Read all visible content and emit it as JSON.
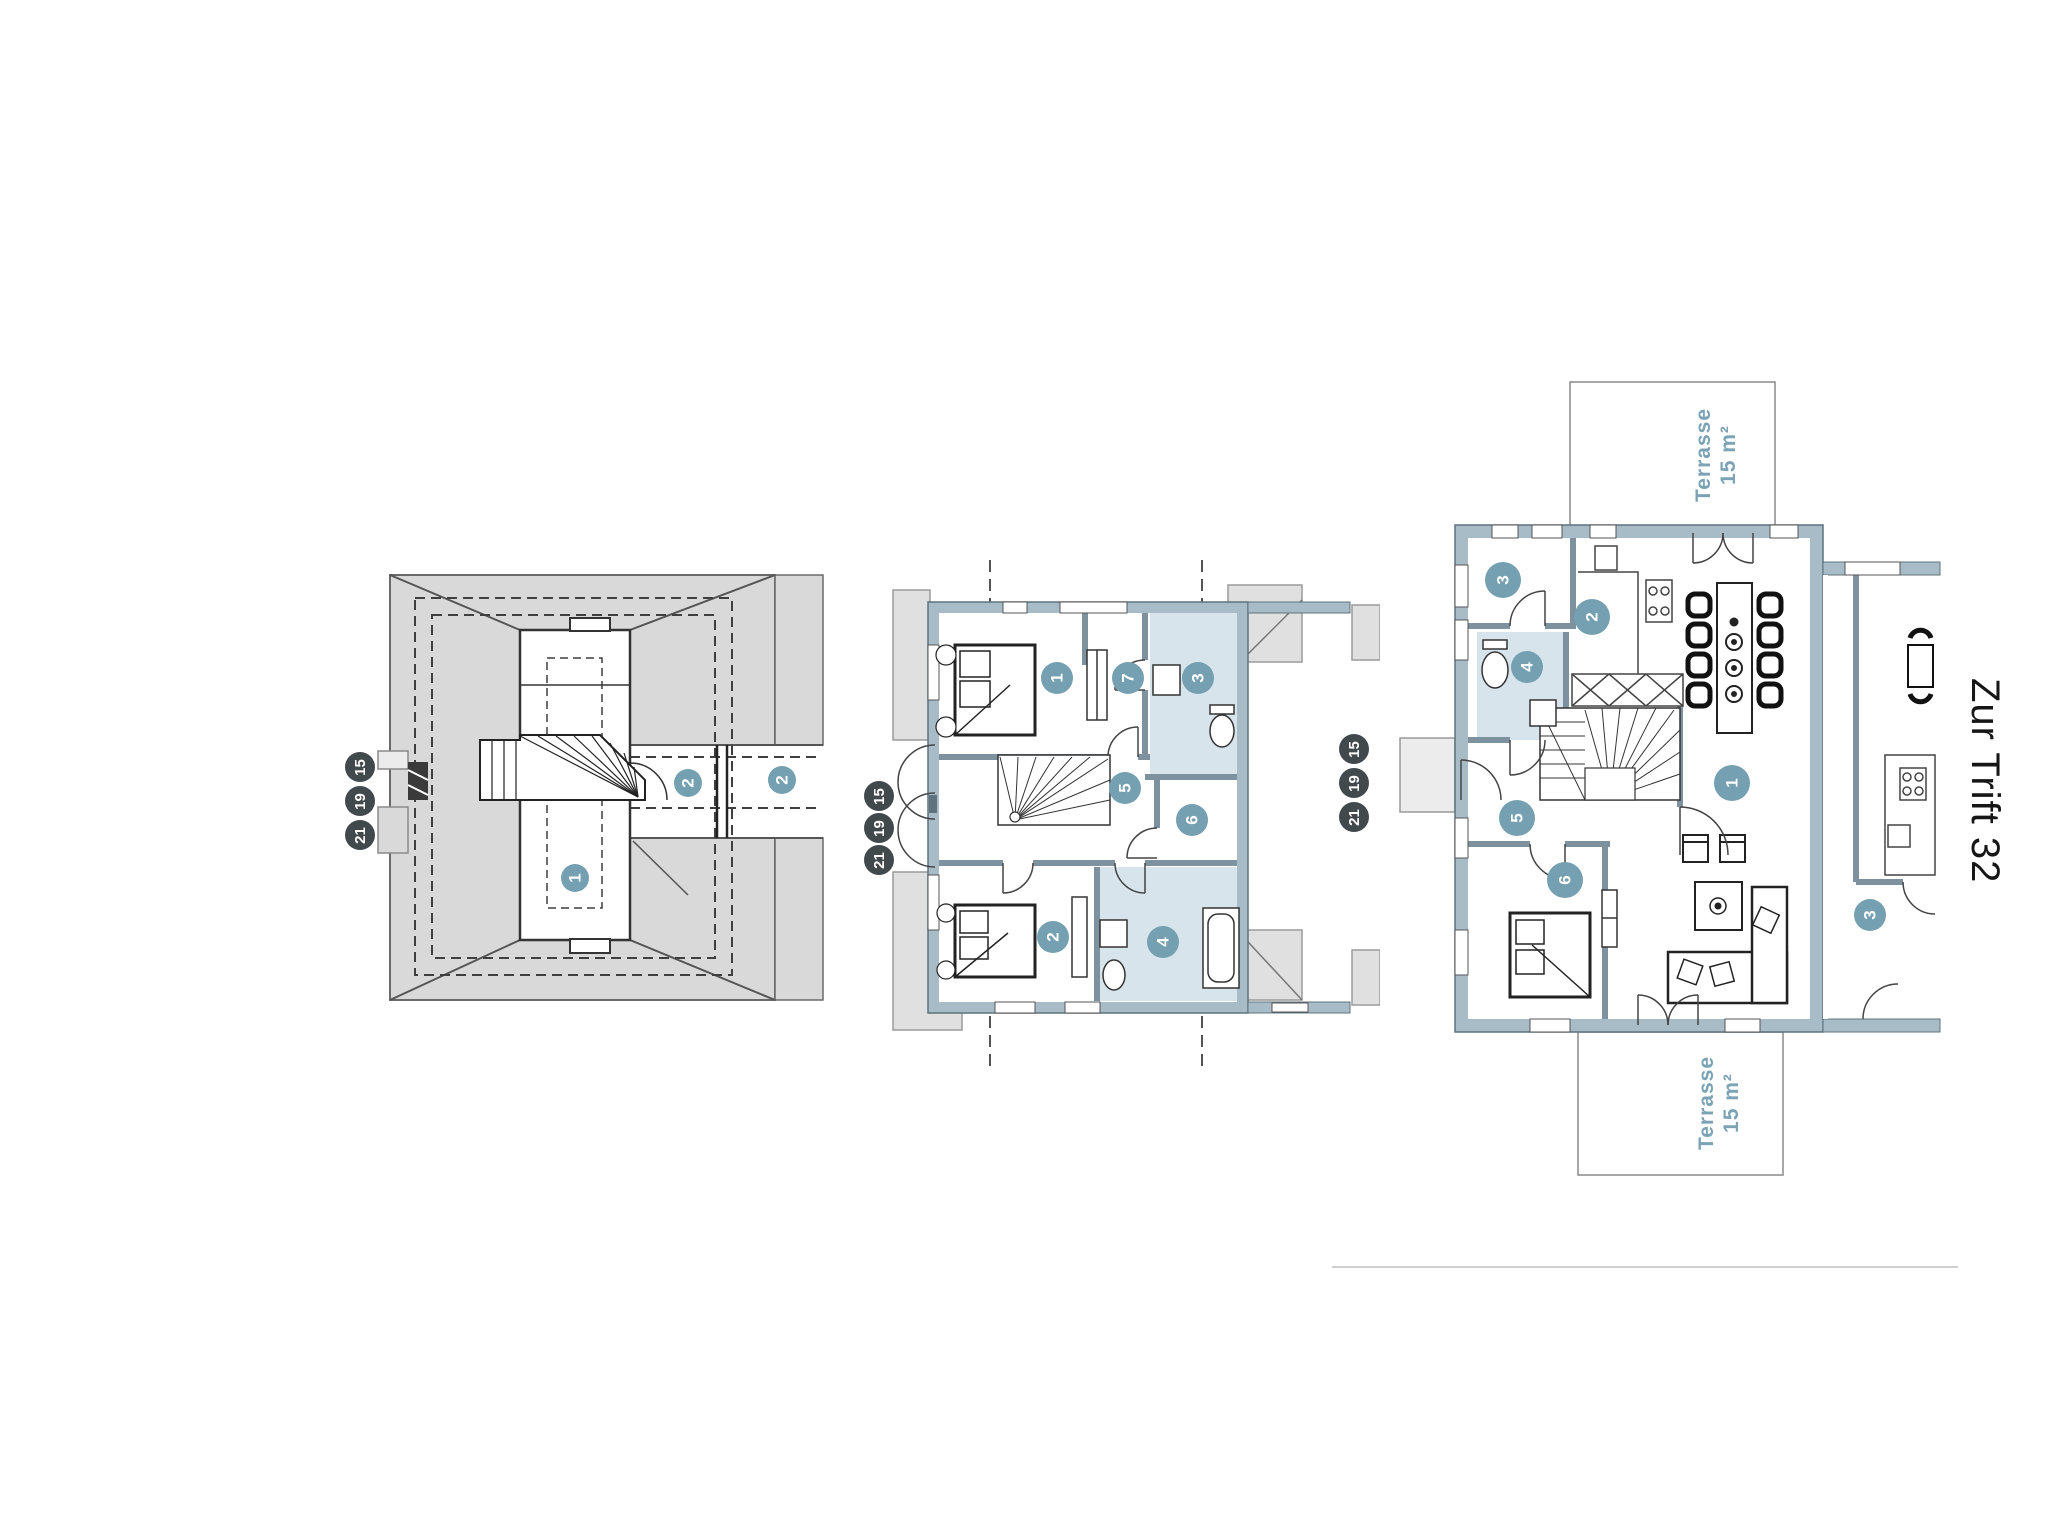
{
  "address_label": "Zur Trift 32",
  "sheet_markers": {
    "values": [
      "15",
      "19",
      "21"
    ]
  },
  "colors": {
    "wall": "#a7bcc7",
    "wall_edge": "#5f737e",
    "roof_gray": "#d9d9d9",
    "bath_floor": "#d7e4eb",
    "room_badge": "#74a0b2",
    "marker_badge": "#42494d",
    "terrace_text": "#7ba3b5",
    "drawing_line": "#3c3c3c"
  },
  "plans": {
    "roof": {
      "room_badges": [
        "1",
        "2",
        "2"
      ]
    },
    "upper": {
      "room_badges": [
        "1",
        "7",
        "3",
        "5",
        "6",
        "2",
        "4"
      ]
    },
    "ground": {
      "room_badges": [
        "3",
        "2",
        "4",
        "1",
        "5",
        "6"
      ],
      "neighbor_badge": "3",
      "terraces": [
        {
          "name": "Terrasse",
          "area": "15 m²"
        },
        {
          "name": "Terrasse",
          "area": "15 m²"
        }
      ]
    }
  }
}
